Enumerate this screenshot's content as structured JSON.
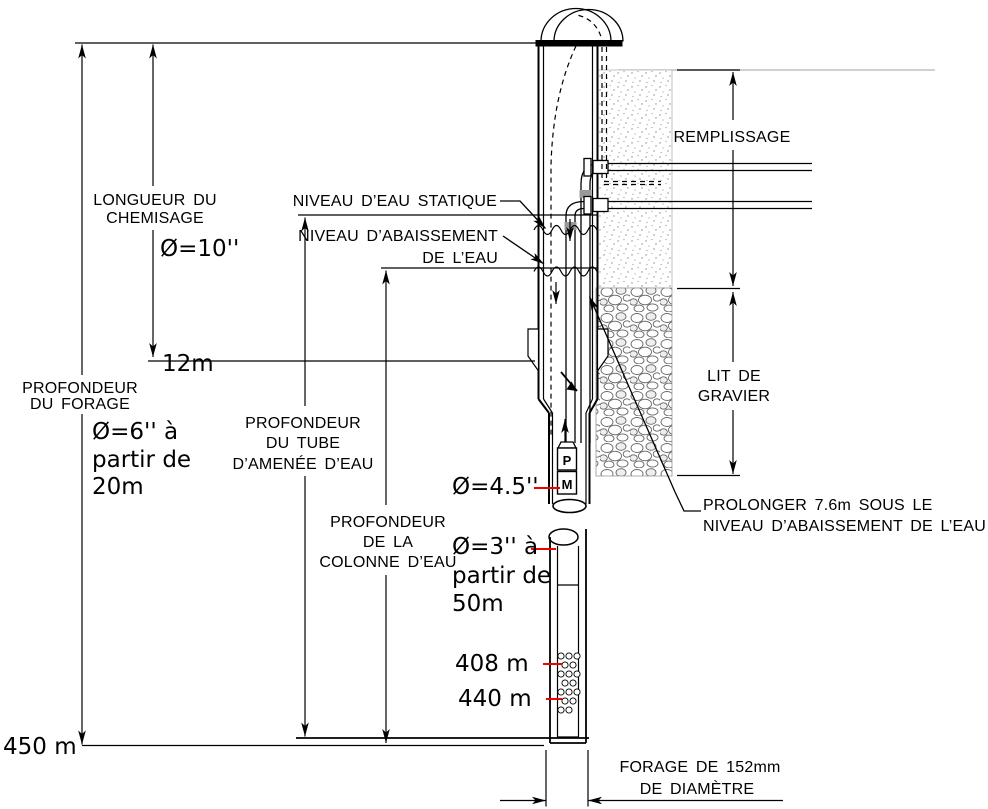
{
  "diagram": {
    "type": "well-drilling-cross-section",
    "colors": {
      "annotation": "#f20000",
      "line": "#000000",
      "ground_line": "#b3b3b3"
    },
    "labels": {
      "longueur_chemisage": {
        "lines": [
          "LONGUEUR DU",
          "CHEMISAGE"
        ]
      },
      "profondeur_forage": {
        "lines": [
          "PROFONDEUR",
          "DU FORAGE"
        ]
      },
      "niveau_statique": {
        "text": "NIVEAU D’EAU STATIQUE"
      },
      "niveau_abaissement": {
        "lines": [
          "NIVEAU D’ABAISSEMENT",
          "DE L’EAU"
        ]
      },
      "profondeur_tube": {
        "lines": [
          "PROFONDEUR",
          "DU TUBE",
          "D’AMENÉE D’EAU"
        ]
      },
      "profondeur_colonne": {
        "lines": [
          "PROFONDEUR",
          "DE LA",
          "COLONNE D’EAU"
        ]
      },
      "remplissage": {
        "text": "REMPLISSAGE"
      },
      "lit_gravier": {
        "lines": [
          "LIT DE",
          "GRAVIER"
        ]
      },
      "prolonger": {
        "lines": [
          "PROLONGER 7.6m SOUS LE",
          "NIVEAU D’ABAISSEMENT DE L’EAU"
        ]
      },
      "forage_diametre": {
        "lines": [
          "FORAGE DE 152mm",
          "DE DIAMÈTRE"
        ]
      }
    },
    "red_notes": {
      "chemisage_diameter": "Ø=10''",
      "chemisage_depth": "12m",
      "borehole_diameter": {
        "lines": [
          "Ø=6'' à",
          "partir de",
          "20m"
        ]
      },
      "pump_casing_diameter": "Ø=4.5''",
      "column_diameter": {
        "lines": [
          "Ø=3'' à",
          "partir de",
          "50m"
        ]
      },
      "screen_top": "408 m",
      "screen_bottom": "440 m",
      "total_depth": "450 m"
    },
    "equipment": {
      "pump_label": "P",
      "motor_label": "M"
    }
  }
}
